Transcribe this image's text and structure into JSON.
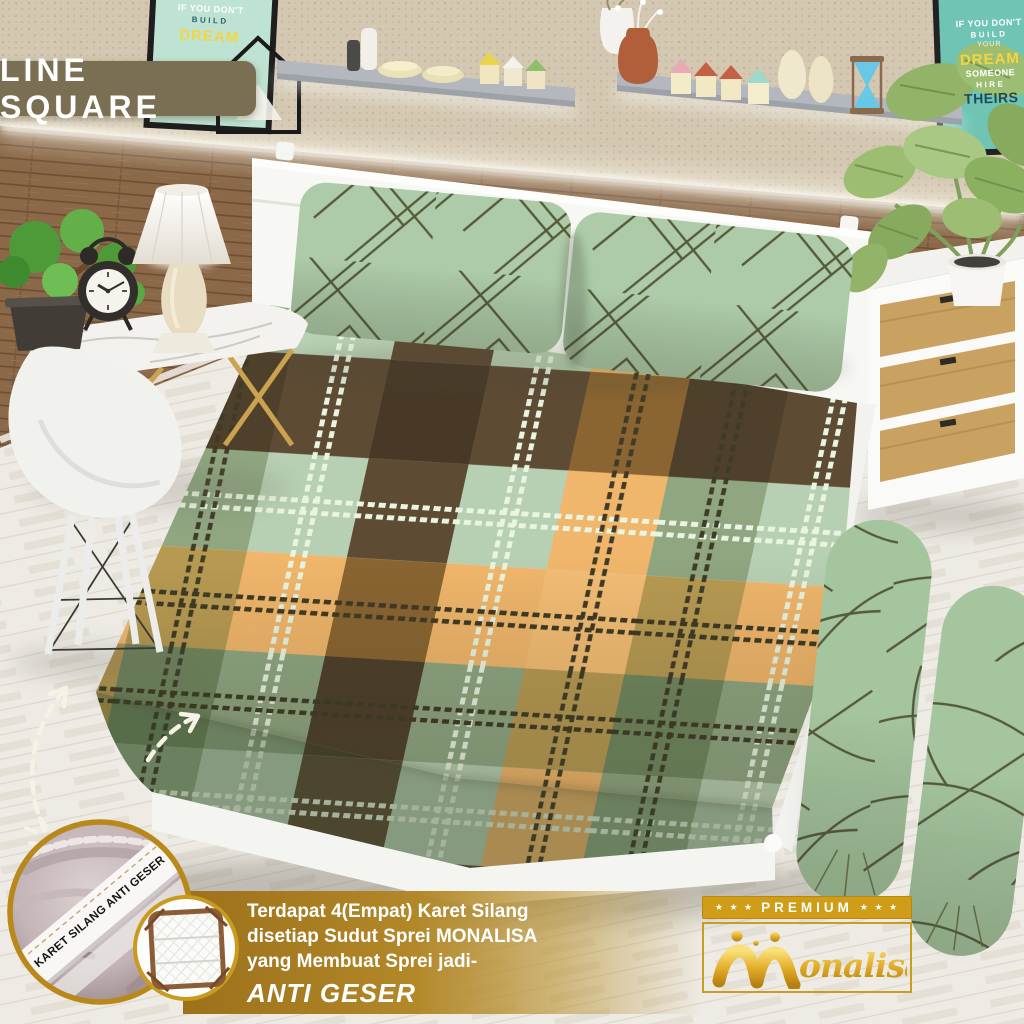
{
  "title_banner": {
    "label": "LINE SQUARE",
    "bg_color": "#7b6f53",
    "text_color": "#ffffff"
  },
  "posters": {
    "left": {
      "lines": [
        "IF YOU DON'T",
        "BUILD",
        "DREAM"
      ]
    },
    "right": {
      "lines": [
        "IF YOU DON'T",
        "BUILD",
        "YOUR",
        "DREAM",
        "SOMEONE",
        "HIRE",
        "THEIRS"
      ]
    }
  },
  "corner_badge": {
    "band_label": "KARET SILANG ANTI GESER"
  },
  "info_banner": {
    "line1": "Terdapat 4(Empat) Karet Silang",
    "line2": "disetiap Sudut Sprei MONALISA",
    "line3": "yang Membuat Sprei jadi-",
    "highlight": "ANTI GESER",
    "bg_gold": "#b28829",
    "text_color": "#ffffff"
  },
  "brand": {
    "premium_label": "PREMIUM",
    "stars": "★ ★ ★",
    "logo_text": "Monalisa",
    "logo_suffix": "onalisa",
    "gold": "#d4a017"
  },
  "scene": {
    "clock_time": "10:10",
    "palette": {
      "plaid_sage": "#b7cfb2",
      "plaid_olive": "#7e9472",
      "plaid_brown": "#5e4b34",
      "plaid_orange": "#f0b66b",
      "pillow_green": "#adcba8",
      "bolster_green": "#a5c59e",
      "wood_wall": "#8a6848",
      "floor": "#e9e5dc",
      "shelf_gray": "#b4b7bd"
    }
  }
}
